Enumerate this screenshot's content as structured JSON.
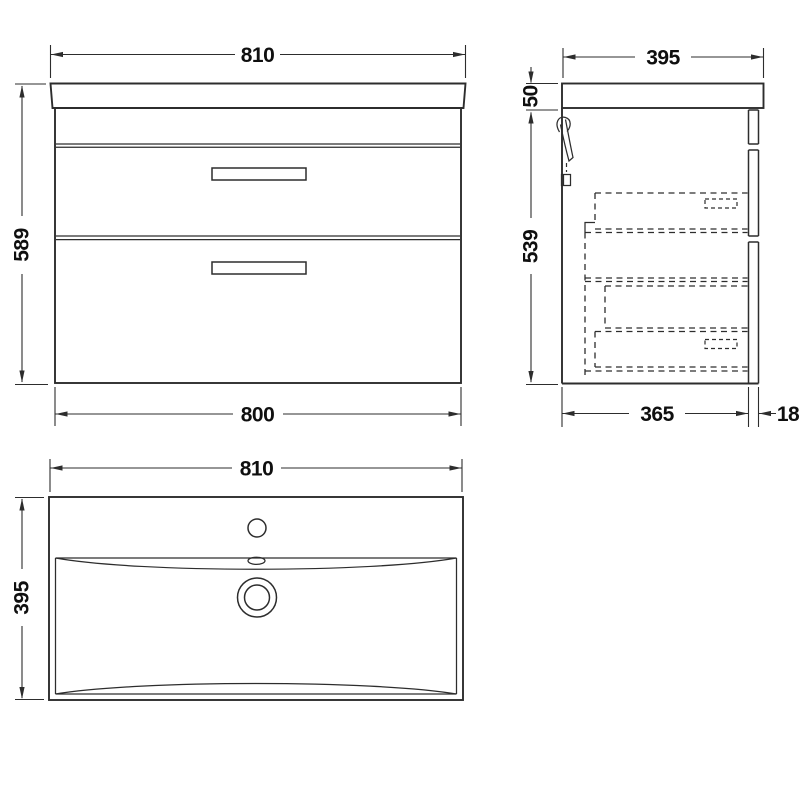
{
  "canvas": {
    "background": "#ffffff",
    "line_color": "#2d2d2d",
    "text_color": "#0f0f0f"
  },
  "views": {
    "front": {
      "label": "front-elevation",
      "dims": {
        "top_width": "810",
        "height": "589",
        "bottom_width": "800"
      }
    },
    "side": {
      "label": "side-elevation",
      "dims": {
        "top_depth": "395",
        "worktop_thickness": "50",
        "cabinet_height": "539",
        "cabinet_depth": "365",
        "front_panel_thickness": "18"
      }
    },
    "plan": {
      "label": "basin-plan",
      "dims": {
        "width": "810",
        "depth": "395"
      }
    }
  }
}
